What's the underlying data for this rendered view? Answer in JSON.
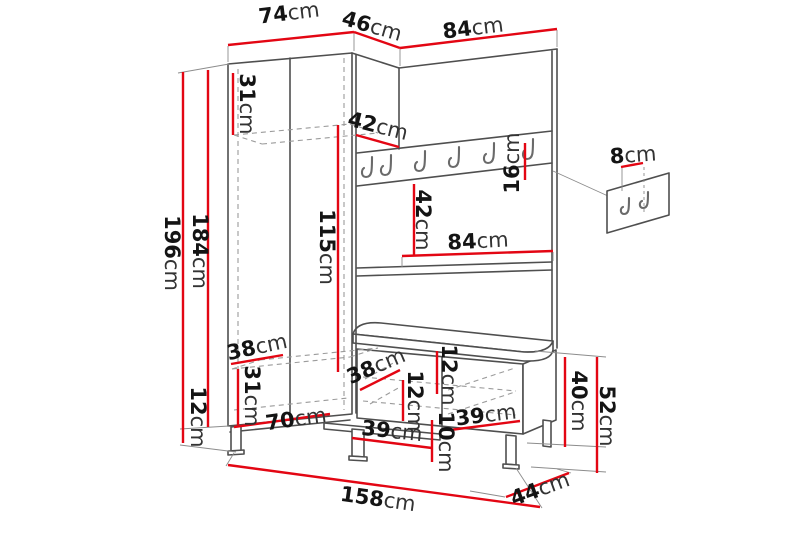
{
  "diagram": {
    "kind": "furniture-dimension-drawing",
    "subject": "hallway wardrobe unit with coat rack panel, shelf, bench and wall hook panel",
    "unit": "cm",
    "accent_color": "#e30613",
    "outline_color": "#4f4f4f",
    "background_color": "#ffffff"
  },
  "labels": [
    {
      "id": "dim-74",
      "text": "74cm",
      "name": "wardrobe-top-width"
    },
    {
      "id": "dim-46",
      "text": "46cm",
      "name": "wardrobe-top-depth"
    },
    {
      "id": "dim-84-top",
      "text": "84cm",
      "name": "panel-top-width"
    },
    {
      "id": "dim-31-top",
      "text": "31cm",
      "name": "wardrobe-upper-shelf-height"
    },
    {
      "id": "dim-196",
      "text": "196cm",
      "name": "total-height"
    },
    {
      "id": "dim-184",
      "text": "184cm",
      "name": "wardrobe-body-height"
    },
    {
      "id": "dim-115",
      "text": "115cm",
      "name": "wardrobe-interior-height"
    },
    {
      "id": "dim-42-rail",
      "text": "42cm",
      "name": "hook-rail-offset"
    },
    {
      "id": "dim-16",
      "text": "16cm",
      "name": "hook-rail-height"
    },
    {
      "id": "dim-42-mid",
      "text": "42cm",
      "name": "rail-to-shelf-distance"
    },
    {
      "id": "dim-84-shelf",
      "text": "84cm",
      "name": "shelf-width"
    },
    {
      "id": "dim-8",
      "text": "8cm",
      "name": "wall-hook-panel-width"
    },
    {
      "id": "dim-38-upper",
      "text": "38cm",
      "name": "wardrobe-shelf-depth"
    },
    {
      "id": "dim-31-lower",
      "text": "31cm",
      "name": "wardrobe-lower-compartment-height"
    },
    {
      "id": "dim-70",
      "text": "70cm",
      "name": "wardrobe-interior-width"
    },
    {
      "id": "dim-12-leg",
      "text": "12cm",
      "name": "leg-height"
    },
    {
      "id": "dim-38-bench",
      "text": "38cm",
      "name": "bench-interior-depth"
    },
    {
      "id": "dim-12-bench-1",
      "text": "12cm",
      "name": "bench-upper-gap"
    },
    {
      "id": "dim-12-bench-2",
      "text": "12cm",
      "name": "bench-middle-gap"
    },
    {
      "id": "dim-10",
      "text": "10cm",
      "name": "bench-lower-gap"
    },
    {
      "id": "dim-39-left",
      "text": "39cm",
      "name": "bench-left-compartment-width"
    },
    {
      "id": "dim-39-right",
      "text": "39cm",
      "name": "bench-right-compartment-width"
    },
    {
      "id": "dim-40",
      "text": "40cm",
      "name": "bench-body-height"
    },
    {
      "id": "dim-52",
      "text": "52cm",
      "name": "bench-total-height"
    },
    {
      "id": "dim-44",
      "text": "44cm",
      "name": "bench-depth"
    },
    {
      "id": "dim-158",
      "text": "158cm",
      "name": "total-width"
    }
  ]
}
